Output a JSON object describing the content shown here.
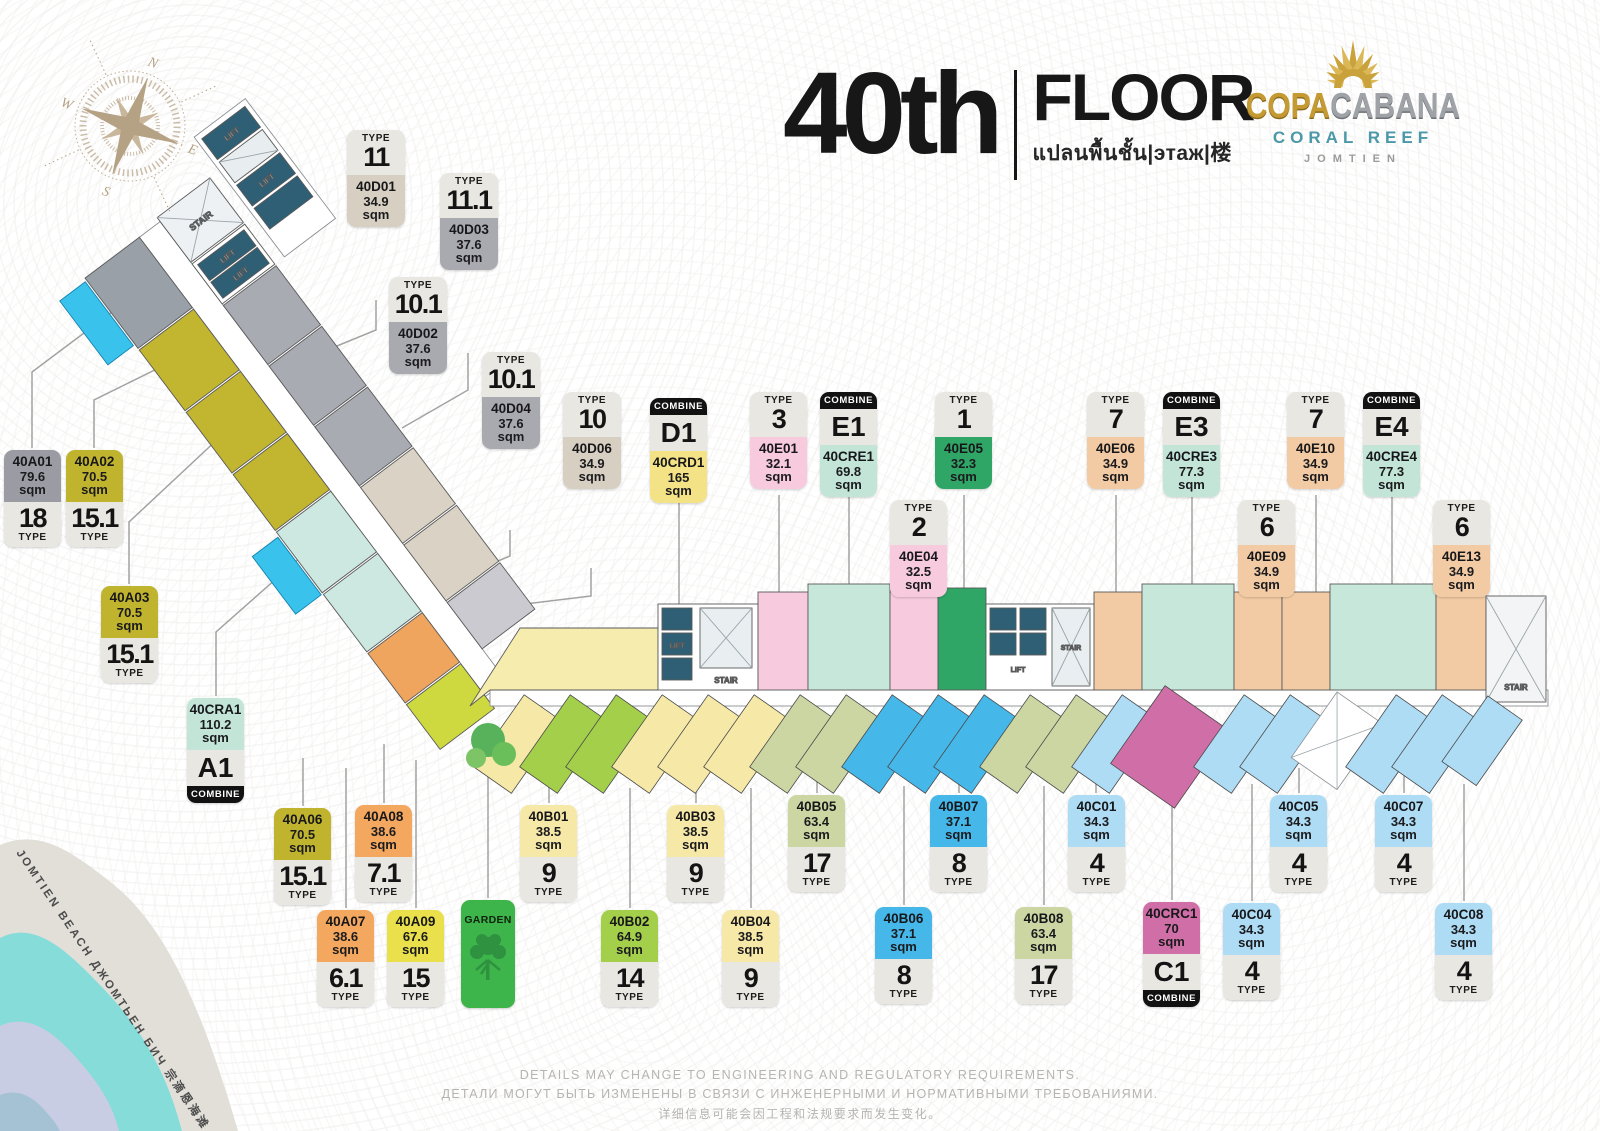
{
  "header": {
    "floor_number": "40th",
    "floor_word": "FLOOR",
    "floor_subtitle": "แปลนพื้นชั้น|этаж|楼"
  },
  "logo": {
    "brand_part1": "COPA",
    "brand_part2": "CABANA",
    "line2": "CORAL REEF",
    "line3": "JOMTIEN"
  },
  "compass": {
    "n": "N",
    "e": "E",
    "s": "S",
    "w": "W"
  },
  "beach": {
    "label": "JOMTIEN BEACH ДЖОМТЬЕН БИЧ 宗滴恩海滩"
  },
  "plan": {
    "lift_label": "LIFT",
    "stair_label": "STAIR"
  },
  "garden": {
    "label": "GARDEN"
  },
  "words": {
    "type": "TYPE",
    "combine": "COMBINE",
    "sqm": "sqm"
  },
  "footer": {
    "line_en": "DETAILS MAY CHANGE TO ENGINEERING AND REGULATORY REQUIREMENTS.",
    "line_ru": "ДЕТАЛИ МОГУТ БЫТЬ ИЗМЕНЕНЫ В СВЯЗИ С ИНЖЕНЕРНЫМИ И НОРМАТИВНЫМИ ТРЕБОВАНИЯМИ.",
    "line_cn": "详细信息可能会因工程和法规要求而发生变化。"
  },
  "label_colors": {
    "gray": "#9b9ba3",
    "olive": "#c0b42f",
    "tan": "#d7cfc2",
    "midgray": "#a9a9b0",
    "yellow": "#f3e286",
    "pink": "#f7cadd",
    "mint": "#c2e5d8",
    "green": "#2fa566",
    "peach": "#f2cba4",
    "orange": "#f3a75f",
    "brightyellow": "#e9e04b",
    "paleyellow": "#f6e9a8",
    "sage": "#cbd6a3",
    "blue": "#45b7e8",
    "lightblue": "#aedcf5",
    "applegreen": "#a4cf4b",
    "magenta": "#d06fa7"
  },
  "units": [
    {
      "id": "40D01",
      "area": "34.9",
      "type": "11",
      "variant": "tt",
      "color": "tan",
      "x": 347,
      "y": 130,
      "w": 58
    },
    {
      "id": "40D03",
      "area": "37.6",
      "type": "11.1",
      "variant": "tt",
      "color": "midgray",
      "x": 440,
      "y": 173,
      "w": 58
    },
    {
      "id": "40D02",
      "area": "37.6",
      "type": "10.1",
      "variant": "tt",
      "color": "midgray",
      "x": 389,
      "y": 277,
      "w": 58
    },
    {
      "id": "40D04",
      "area": "37.6",
      "type": "10.1",
      "variant": "tt",
      "color": "midgray",
      "x": 482,
      "y": 352,
      "w": 58
    },
    {
      "id": "40D06",
      "area": "34.9",
      "type": "10",
      "variant": "tt",
      "color": "tan",
      "x": 563,
      "y": 392,
      "w": 58
    },
    {
      "id": "40CRD1",
      "area": "165",
      "code": "D1",
      "variant": "ct",
      "color": "yellow",
      "x": 650,
      "y": 398
    },
    {
      "id": "40E01",
      "area": "32.1",
      "type": "3",
      "variant": "tt",
      "color": "pink",
      "x": 750,
      "y": 392
    },
    {
      "id": "40CRE1",
      "area": "69.8",
      "code": "E1",
      "variant": "ct",
      "color": "mint",
      "x": 820,
      "y": 392
    },
    {
      "id": "40E05",
      "area": "32.3",
      "type": "1",
      "variant": "tt",
      "color": "green",
      "x": 935,
      "y": 392
    },
    {
      "id": "40E04",
      "area": "32.5",
      "type": "2",
      "variant": "tt",
      "color": "pink",
      "x": 890,
      "y": 500
    },
    {
      "id": "40E06",
      "area": "34.9",
      "type": "7",
      "variant": "tt",
      "color": "peach",
      "x": 1087,
      "y": 392
    },
    {
      "id": "40CRE3",
      "area": "77.3",
      "code": "E3",
      "variant": "ct",
      "color": "mint",
      "x": 1163,
      "y": 392
    },
    {
      "id": "40E09",
      "area": "34.9",
      "type": "6",
      "variant": "tt",
      "color": "peach",
      "x": 1238,
      "y": 500
    },
    {
      "id": "40E10",
      "area": "34.9",
      "type": "7",
      "variant": "tt",
      "color": "peach",
      "x": 1287,
      "y": 392
    },
    {
      "id": "40CRE4",
      "area": "77.3",
      "code": "E4",
      "variant": "ct",
      "color": "mint",
      "x": 1363,
      "y": 392
    },
    {
      "id": "40E13",
      "area": "34.9",
      "type": "6",
      "variant": "tt",
      "color": "peach",
      "x": 1433,
      "y": 500
    },
    {
      "id": "40A01",
      "area": "79.6",
      "type": "18",
      "variant": "ut",
      "color": "gray",
      "x": 4,
      "y": 450
    },
    {
      "id": "40A02",
      "area": "70.5",
      "type": "15.1",
      "variant": "ut",
      "color": "olive",
      "x": 66,
      "y": 450
    },
    {
      "id": "40A03",
      "area": "70.5",
      "type": "15.1",
      "variant": "ut",
      "color": "olive",
      "x": 101,
      "y": 586
    },
    {
      "id": "40CRA1",
      "area": "110.2",
      "code": "A1",
      "variant": "cb",
      "color": "mint",
      "x": 187,
      "y": 698
    },
    {
      "id": "40A06",
      "area": "70.5",
      "type": "15.1",
      "variant": "ut",
      "color": "olive",
      "x": 274,
      "y": 808
    },
    {
      "id": "40A08",
      "area": "38.6",
      "type": "7.1",
      "variant": "ut",
      "color": "orange",
      "x": 355,
      "y": 805
    },
    {
      "id": "40A07",
      "area": "38.6",
      "type": "6.1",
      "variant": "ut",
      "color": "orange",
      "x": 317,
      "y": 910
    },
    {
      "id": "40A09",
      "area": "67.6",
      "type": "15",
      "variant": "ut",
      "color": "brightyellow",
      "x": 387,
      "y": 910
    },
    {
      "id": "40B01",
      "area": "38.5",
      "type": "9",
      "variant": "ut",
      "color": "paleyellow",
      "x": 520,
      "y": 805
    },
    {
      "id": "40B02",
      "area": "64.9",
      "type": "14",
      "variant": "ut",
      "color": "applegreen",
      "x": 601,
      "y": 910
    },
    {
      "id": "40B03",
      "area": "38.5",
      "type": "9",
      "variant": "ut",
      "color": "paleyellow",
      "x": 667,
      "y": 805
    },
    {
      "id": "40B04",
      "area": "38.5",
      "type": "9",
      "variant": "ut",
      "color": "paleyellow",
      "x": 722,
      "y": 910
    },
    {
      "id": "40B05",
      "area": "63.4",
      "type": "17",
      "variant": "ut",
      "color": "sage",
      "x": 788,
      "y": 795
    },
    {
      "id": "40B06",
      "area": "37.1",
      "type": "8",
      "variant": "ut",
      "color": "blue",
      "x": 875,
      "y": 907
    },
    {
      "id": "40B07",
      "area": "37.1",
      "type": "8",
      "variant": "ut",
      "color": "blue",
      "x": 930,
      "y": 795
    },
    {
      "id": "40B08",
      "area": "63.4",
      "type": "17",
      "variant": "ut",
      "color": "sage",
      "x": 1015,
      "y": 907
    },
    {
      "id": "40C01",
      "area": "34.3",
      "type": "4",
      "variant": "ut",
      "color": "lightblue",
      "x": 1068,
      "y": 795
    },
    {
      "id": "40CRC1",
      "area": "70",
      "code": "C1",
      "variant": "cb",
      "color": "magenta",
      "x": 1143,
      "y": 902
    },
    {
      "id": "40C04",
      "area": "34.3",
      "type": "4",
      "variant": "ut",
      "color": "lightblue",
      "x": 1223,
      "y": 903
    },
    {
      "id": "40C05",
      "area": "34.3",
      "type": "4",
      "variant": "ut",
      "color": "lightblue",
      "x": 1270,
      "y": 795
    },
    {
      "id": "40C07",
      "area": "34.3",
      "type": "4",
      "variant": "ut",
      "color": "lightblue",
      "x": 1375,
      "y": 795
    },
    {
      "id": "40C08",
      "area": "34.3",
      "type": "4",
      "variant": "ut",
      "color": "lightblue",
      "x": 1435,
      "y": 903
    }
  ]
}
